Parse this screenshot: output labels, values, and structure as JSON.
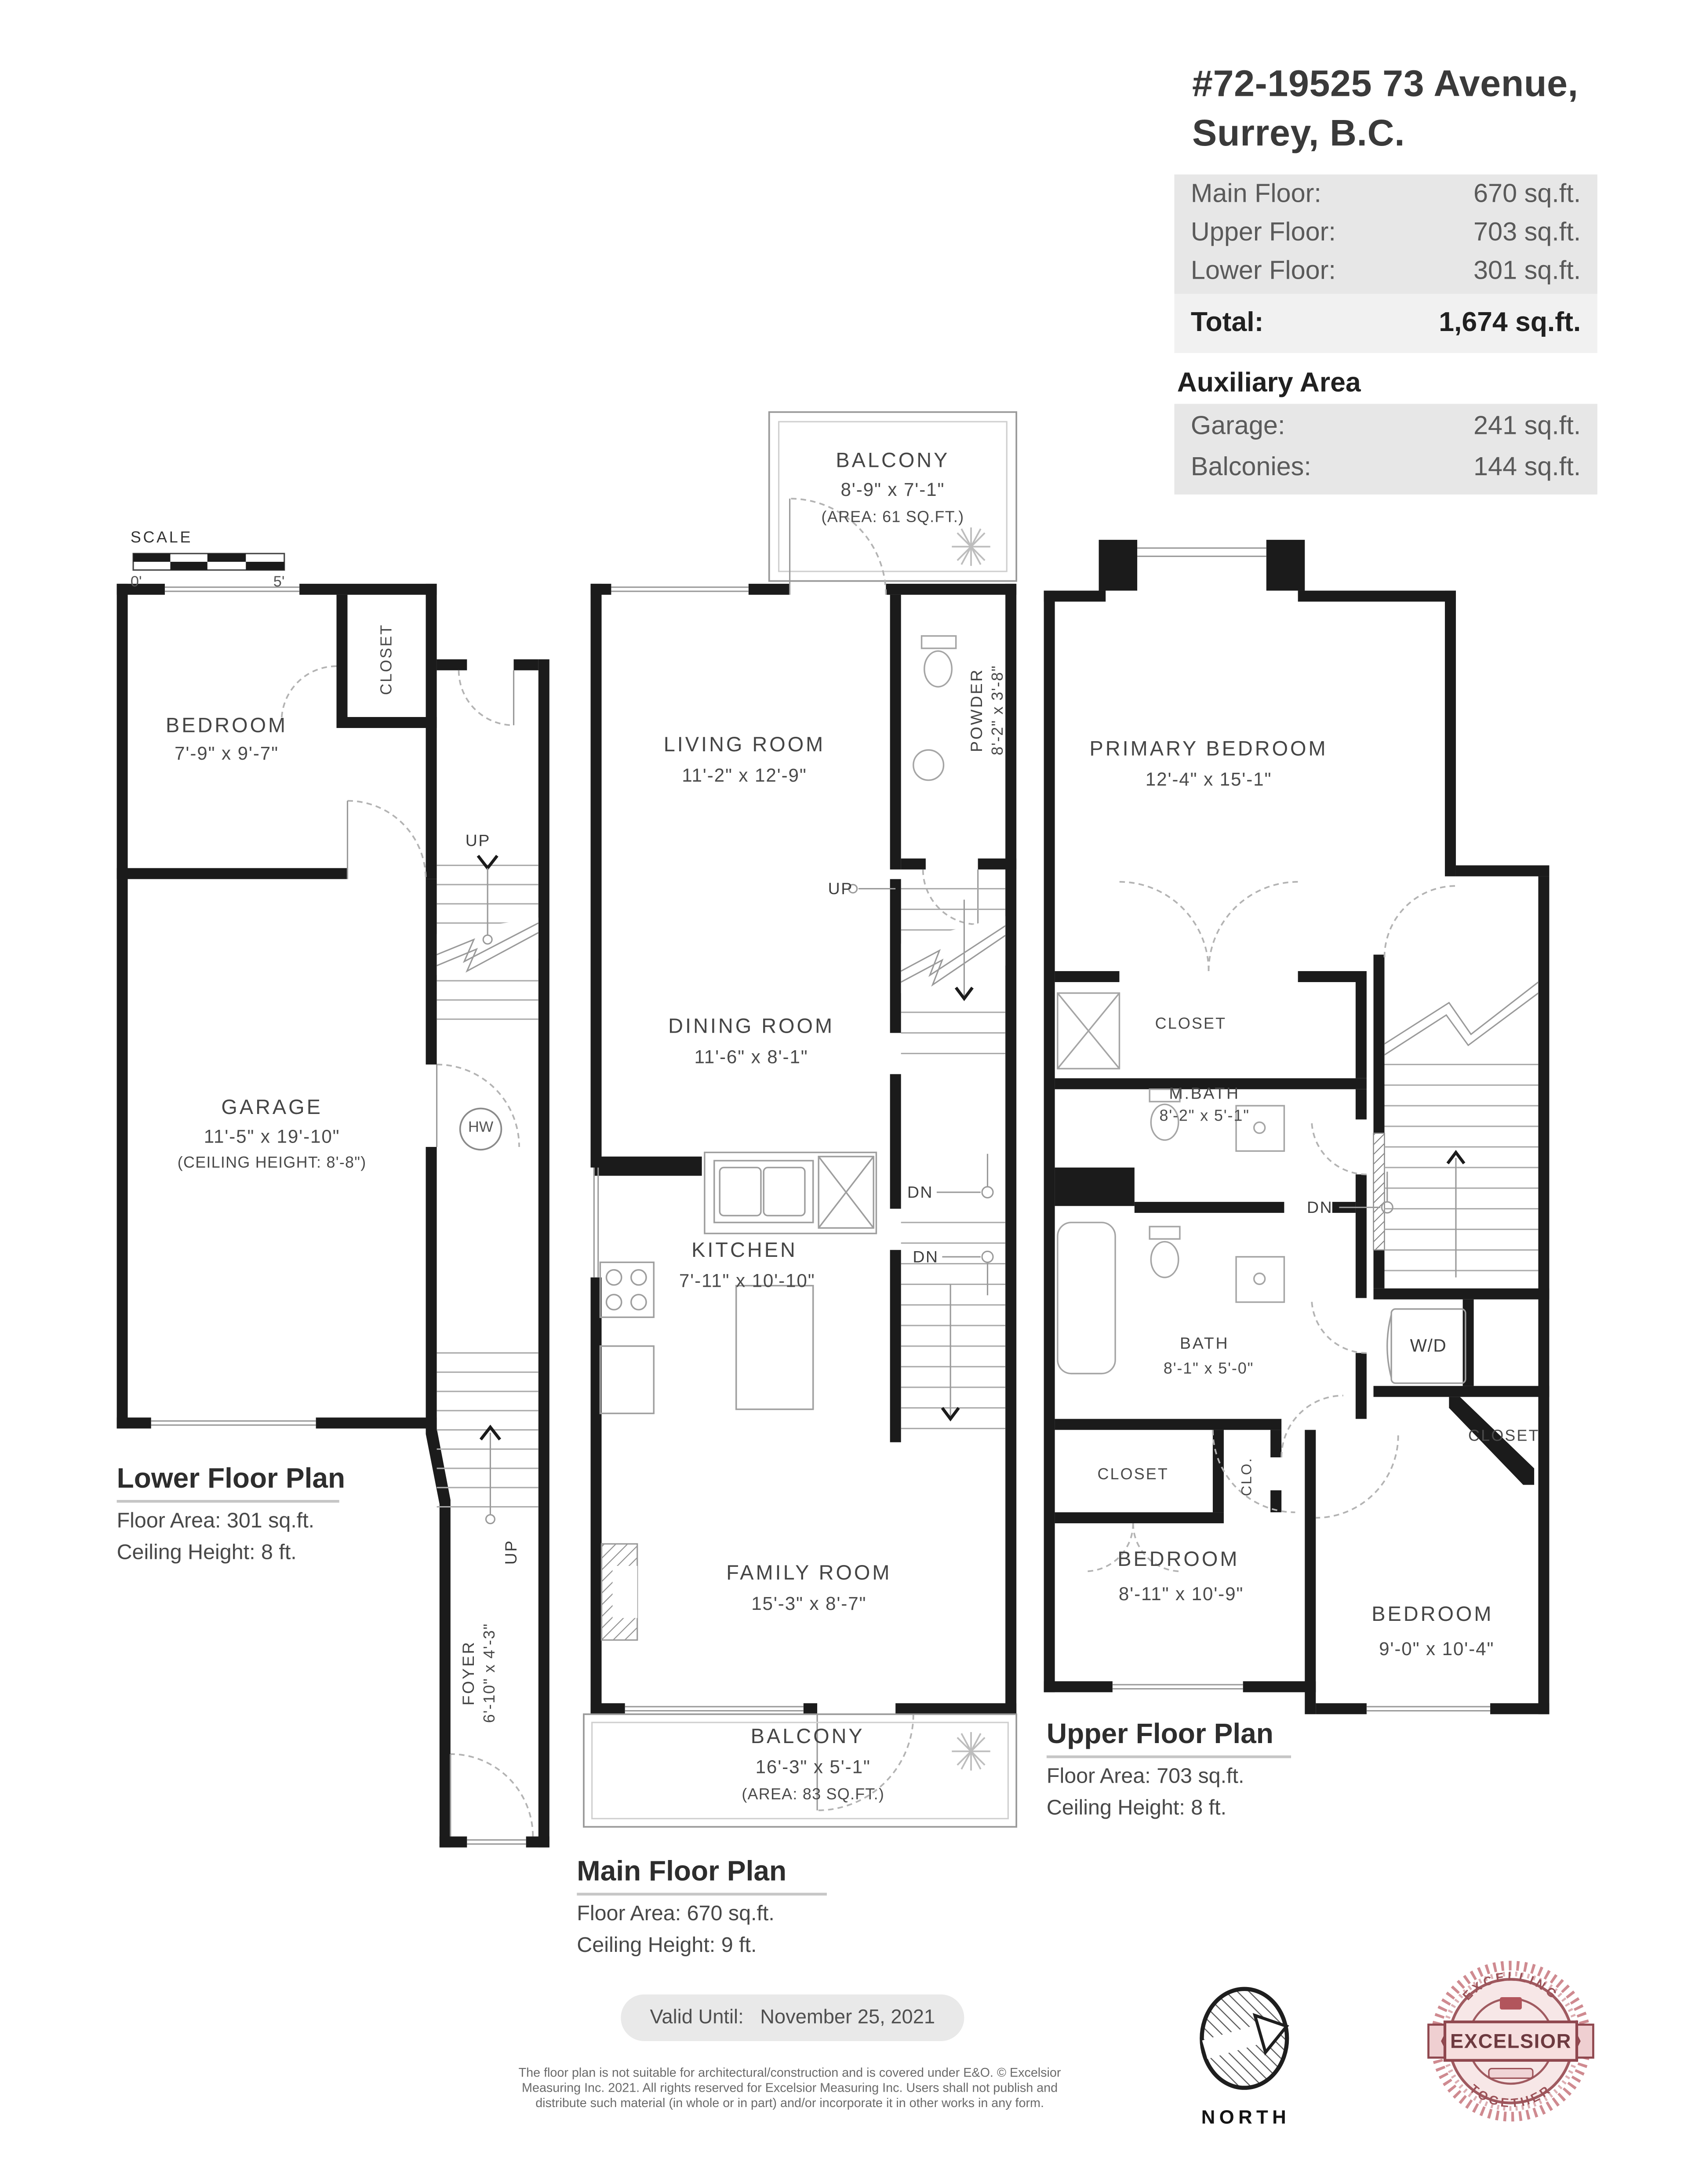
{
  "header": {
    "address_line1": "#72-19525 73 Avenue,",
    "address_line2": "Surrey, B.C.",
    "floors": [
      {
        "label": "Main Floor:",
        "value": "670 sq.ft."
      },
      {
        "label": "Upper Floor:",
        "value": "703 sq.ft."
      },
      {
        "label": "Lower Floor:",
        "value": "301 sq.ft."
      }
    ],
    "total_label": "Total:",
    "total_value": "1,674 sq.ft.",
    "auxiliary_heading": "Auxiliary Area",
    "auxiliary": [
      {
        "label": "Garage:",
        "value": "241 sq.ft."
      },
      {
        "label": "Balconies:",
        "value": "144 sq.ft."
      }
    ]
  },
  "scale": {
    "label": "SCALE",
    "start": "0'",
    "end": "5'"
  },
  "lower": {
    "title": "Lower Floor Plan",
    "floor_area": "Floor Area: 301 sq.ft.",
    "ceiling": "Ceiling Height: 8 ft.",
    "rooms": {
      "bedroom": {
        "name": "BEDROOM",
        "dims": "7'-9\" x 9'-7\""
      },
      "closet": "CLOSET",
      "garage": {
        "name": "GARAGE",
        "dims": "11'-5\" x 19'-10\"",
        "note": "(CEILING HEIGHT: 8'-8\")"
      },
      "foyer": {
        "name": "FOYER",
        "dims": "6'-10\" x 4'-3\""
      }
    },
    "labels": {
      "up_top": "UP",
      "up_bottom": "UP",
      "hw": "HW"
    }
  },
  "main": {
    "title": "Main Floor Plan",
    "floor_area": "Floor Area: 670 sq.ft.",
    "ceiling": "Ceiling Height: 9 ft.",
    "balcony_top": {
      "name": "BALCONY",
      "dims": "8'-9\" x 7'-1\"",
      "area": "(AREA: 61 SQ.FT.)"
    },
    "balcony_bottom": {
      "name": "BALCONY",
      "dims": "16'-3\" x 5'-1\"",
      "area": "(AREA: 83 SQ.FT.)"
    },
    "rooms": {
      "living": {
        "name": "LIVING ROOM",
        "dims": "11'-2\" x 12'-9\""
      },
      "powder": {
        "name": "POWDER",
        "dims": "8'-2\" x 3'-8\""
      },
      "dining": {
        "name": "DINING ROOM",
        "dims": "11'-6\" x 8'-1\""
      },
      "kitchen": {
        "name": "KITCHEN",
        "dims": "7'-11\" x 10'-10\""
      },
      "family": {
        "name": "FAMILY ROOM",
        "dims": "15'-3\" x 8'-7\""
      }
    },
    "labels": {
      "up": "UP",
      "dn1": "DN",
      "dn2": "DN"
    }
  },
  "upper": {
    "title": "Upper Floor Plan",
    "floor_area": "Floor Area: 703 sq.ft.",
    "ceiling": "Ceiling Height: 8 ft.",
    "rooms": {
      "primary": {
        "name": "PRIMARY BEDROOM",
        "dims": "12'-4\" x 15'-1\""
      },
      "closet_primary": "CLOSET",
      "mbath": {
        "name": "M.BATH",
        "dims": "8'-2\" x 5'-1\""
      },
      "bath": {
        "name": "BATH",
        "dims": "8'-1\" x 5'-0\""
      },
      "wd": "W/D",
      "closet_left": "CLOSET",
      "clo": "CLO.",
      "closet_right": "CLOSET",
      "bedroom_left": {
        "name": "BEDROOM",
        "dims": "8'-11\" x 10'-9\""
      },
      "bedroom_right": {
        "name": "BEDROOM",
        "dims": "9'-0\" x 10'-4\""
      }
    },
    "labels": {
      "dn": "DN"
    }
  },
  "footer": {
    "valid_label": "Valid Until:",
    "valid_date": "November 25, 2021",
    "disclaimer_line1": "The floor plan is not suitable for architectural/construction and is covered under E&O. © Excelsior",
    "disclaimer_line2": "Measuring Inc. 2021. All rights reserved for Excelsior Measuring Inc. Users shall not publish and",
    "disclaimer_line3": "distribute such material (in whole or in part) and/or incorporate it in other works in any form.",
    "north_label": "NORTH",
    "badge": {
      "top": "EXCELLING",
      "middle": "EXCELSIOR",
      "bottom": "TOGETHER"
    }
  },
  "colors": {
    "wall": "#1b1b1b",
    "panel": "#e7e7e7",
    "panel_light": "#f1f1f1",
    "text": "#474747",
    "badge_red": "#9c5258"
  }
}
